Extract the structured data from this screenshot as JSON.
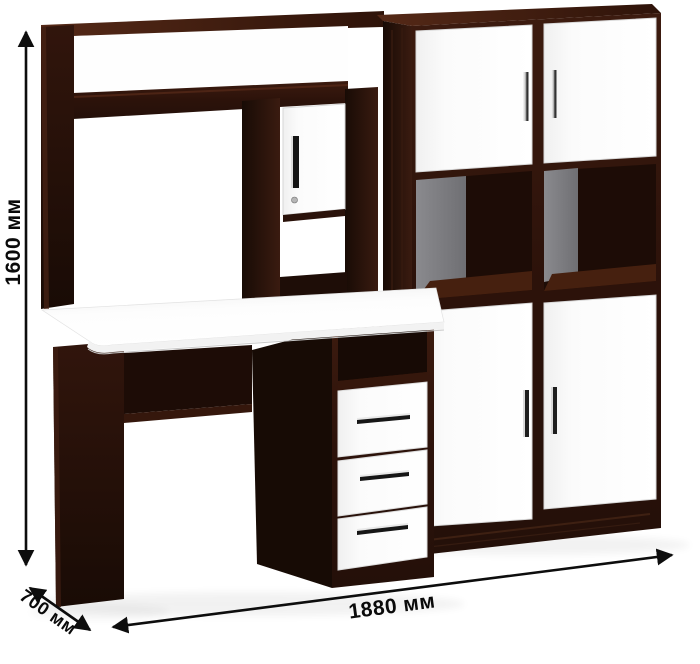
{
  "dimensions": {
    "height": "1600 мм",
    "depth": "700 мм",
    "width": "1880 мм"
  },
  "colors": {
    "wenge_dark": "#2a1109",
    "wenge_mid": "#3a1a0f",
    "wenge_light": "#4c2414",
    "front_white": "#ffffff",
    "back_panel_gray": "#7e7e82",
    "handle_chrome": "#e9e9e9",
    "handle_black": "#161616",
    "arrow_black": "#0d0d0d",
    "background": "#ffffff"
  }
}
